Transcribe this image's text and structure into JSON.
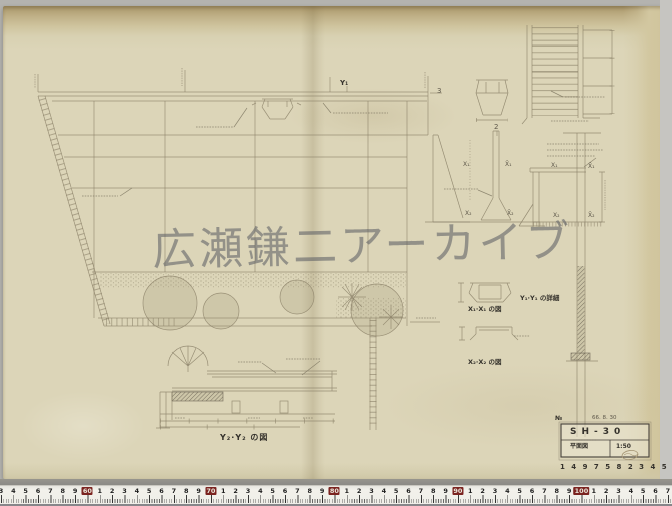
{
  "photo": {
    "watermark": "広瀬鎌二アーカイブ"
  },
  "title_block": {
    "no_mark": "№",
    "date_note": "66. 8. 30",
    "drawing_no": "SH-30",
    "drawing_title": "平面図",
    "scale": "1:50",
    "stamp_row": "1 4 9  7 5 8 2 3 4 5 9"
  },
  "section_labels": {
    "x1x1": "X₁·X₁ の図",
    "x2x2": "X₂·X₂ の図",
    "y1y1": "Y₁·Y₁ の詳細",
    "bottom_section": "Y₂·Y₂ の図"
  },
  "marks": {
    "y1_grid": "Y₁",
    "grid_3": "3",
    "grid_2": "2",
    "elev_x1": "X₁",
    "elev_x1r": "X̄₁",
    "elev_x2": "X₂",
    "elev_x2r": "X̄₂",
    "sect_x1": "X₁",
    "sect_x1r": "X̄₁",
    "sect_x2": "X₂",
    "sect_x2r": "X̄₂"
  },
  "ruler": {
    "start": 53,
    "end": 107,
    "decade_labels": [
      "60",
      "70",
      "80",
      "90",
      "100"
    ],
    "decade_color": "#7b2320"
  },
  "colors": {
    "paper": "#dcd5b8",
    "paper_edge": "#b7a87e",
    "pencil": "#8b8168",
    "ink": "#45403a",
    "watermark_gray": "#5f6166",
    "ruler_red": "#7b2320"
  }
}
